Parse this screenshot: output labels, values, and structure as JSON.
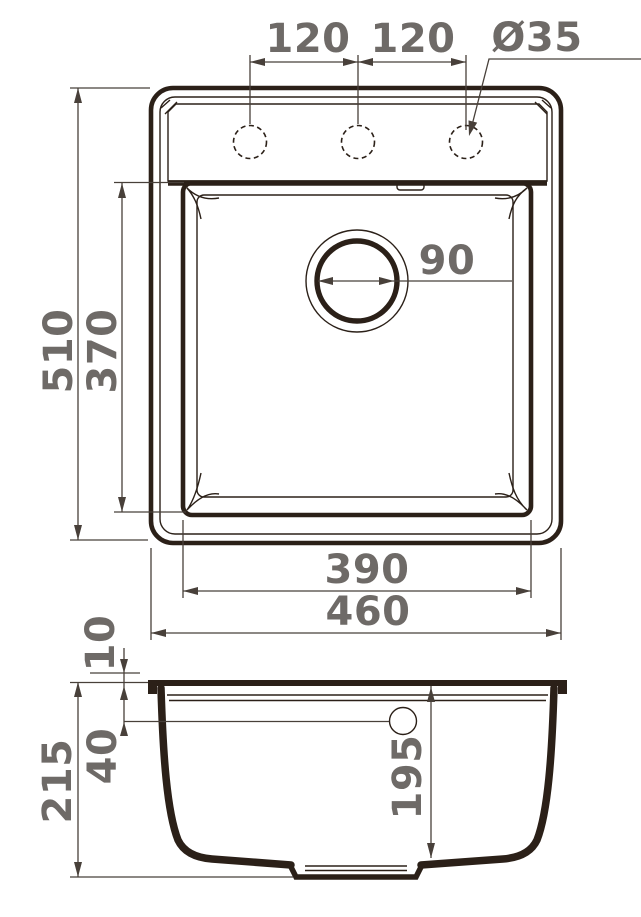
{
  "drawing": {
    "top_view": {
      "hole_spacing_left": "120",
      "hole_spacing_right": "120",
      "faucet_hole_diameter": "Ø35",
      "drain_diameter": "90",
      "overall_length": "510",
      "bowl_length": "370",
      "bowl_width": "390",
      "overall_width": "460"
    },
    "side_view": {
      "rim_height": "10",
      "overflow_depth": "40",
      "overall_depth": "215",
      "bowl_depth": "195"
    },
    "colors": {
      "outline": "#2b2018",
      "dimension_lines": "#48403a",
      "label_text": "#6e6a67",
      "background": "#ffffff"
    }
  }
}
